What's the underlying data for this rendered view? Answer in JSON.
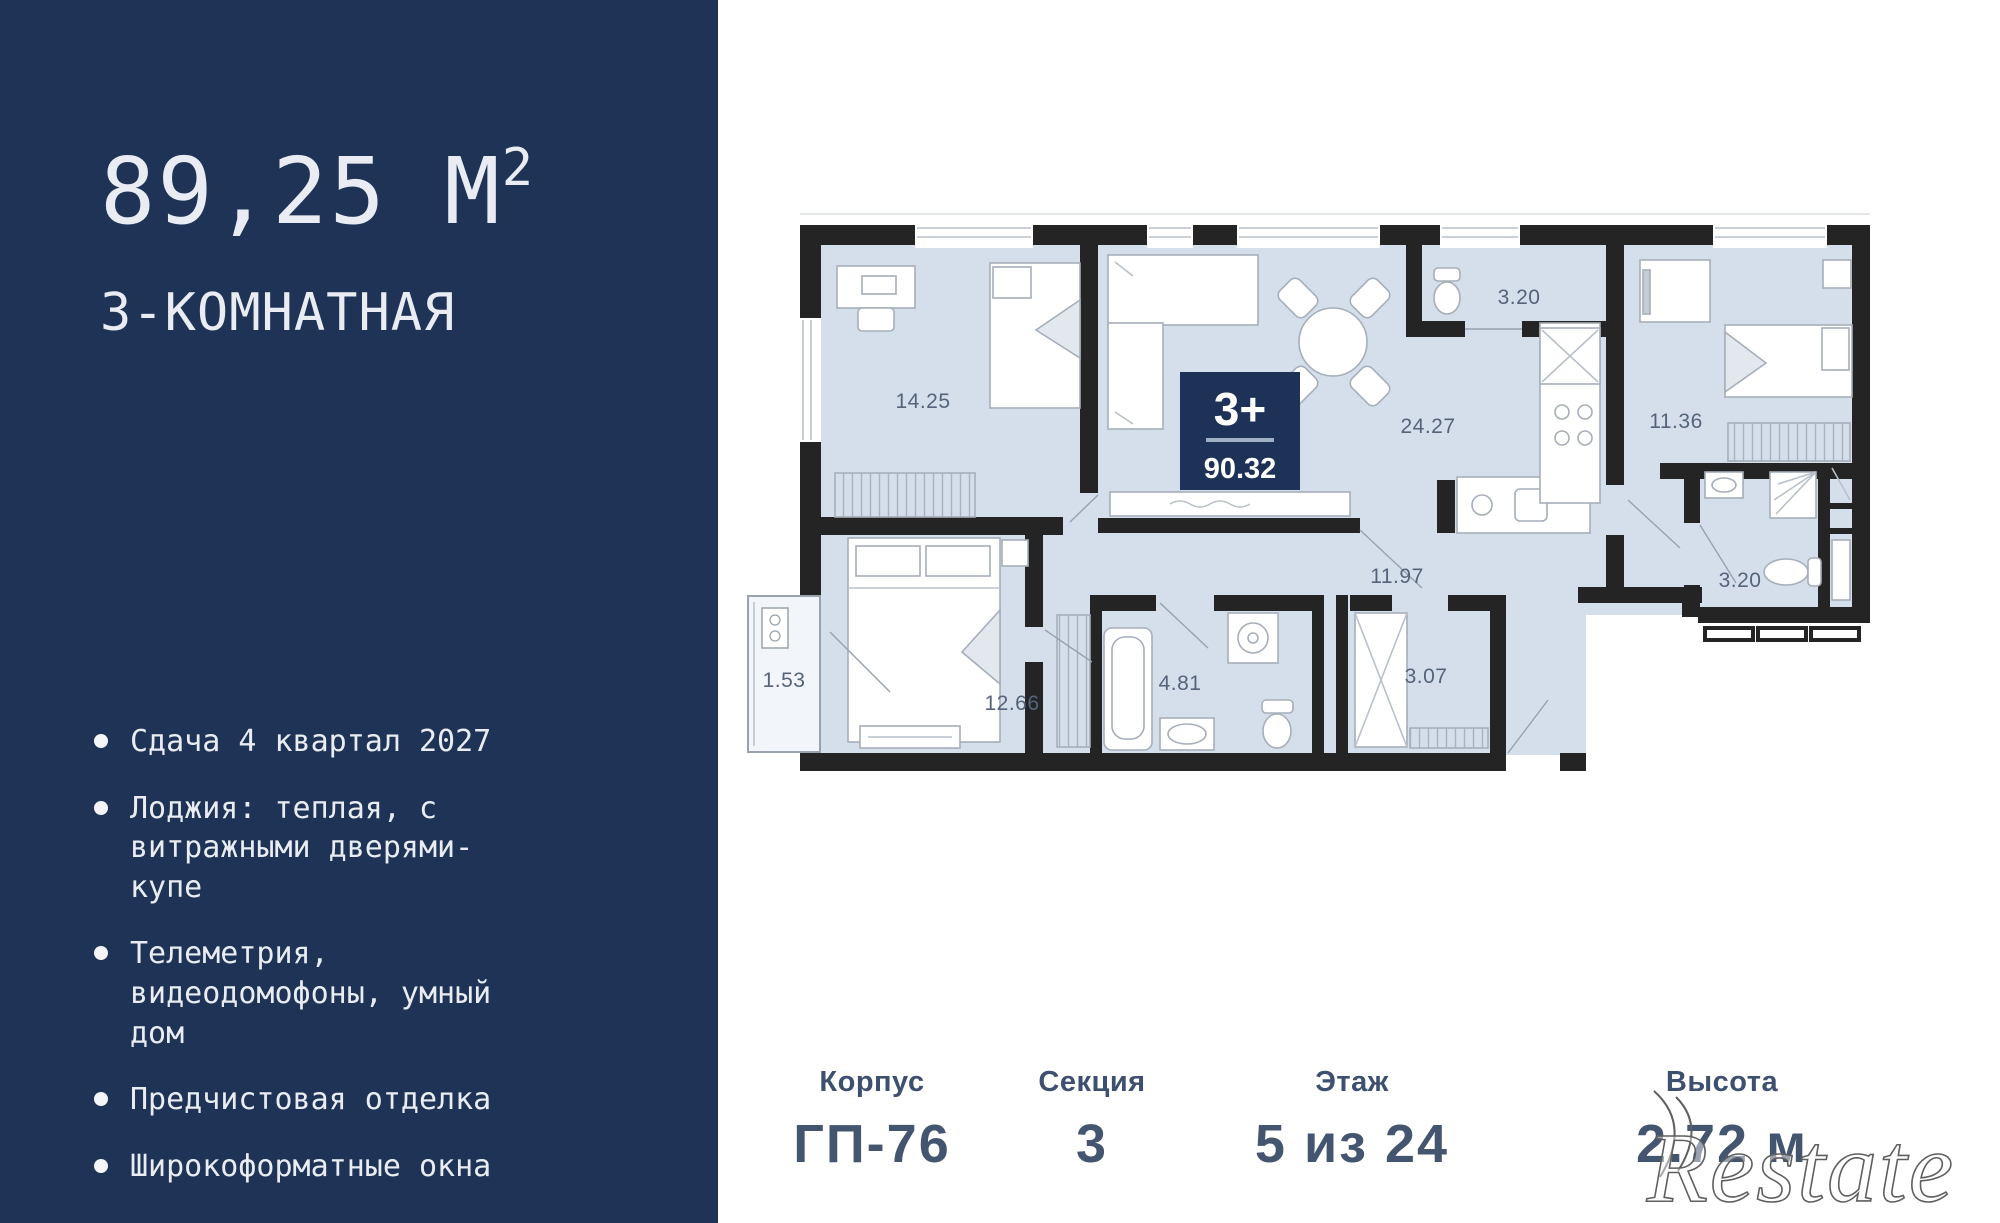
{
  "sidebar": {
    "area_value": "89,25",
    "area_unit": "М",
    "area_sup": "2",
    "subtitle": "3-КОМНАТНАЯ",
    "features": [
      "Сдача 4 квартал 2027",
      "Лоджия: теплая, с витражными дверями-купе",
      "Телеметрия, видеодомофоны, умный дом",
      "Предчистовая отделка",
      "Широкоформатные окна"
    ]
  },
  "plan": {
    "badge": {
      "rooms": "3+",
      "total_area": "90.32"
    },
    "rooms": {
      "bedroom1": "14.25",
      "wc_top": "3.20",
      "living": "24.27",
      "bedroom2": "11.36",
      "loggia": "1.53",
      "bedroom3": "12.66",
      "bathroom": "4.81",
      "laundry": "3.07",
      "hallway": "11.97",
      "shower_room": "3.20"
    }
  },
  "footer": {
    "items": [
      {
        "label": "Корпус",
        "value": "ГП-76"
      },
      {
        "label": "Секция",
        "value": "3"
      },
      {
        "label": "Этаж",
        "value": "5 из 24"
      },
      {
        "label": "Высота",
        "value": "2.72 м"
      }
    ]
  },
  "watermark": "Restate",
  "colors": {
    "sidebar": "#1e3355",
    "floor": "#d5dfeb",
    "wall": "#242424",
    "plan_text": "#55647a"
  }
}
